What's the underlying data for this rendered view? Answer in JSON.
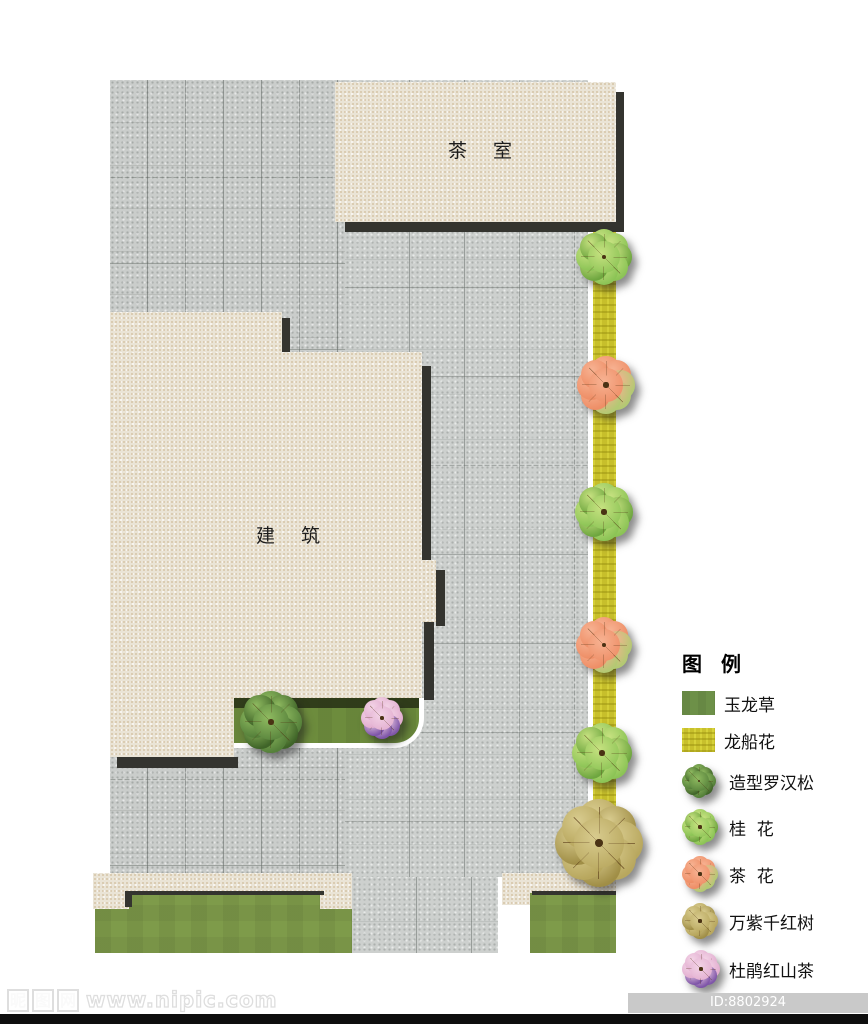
{
  "plan": {
    "labels": {
      "tea_room": "茶   室",
      "building": "建   筑"
    },
    "legend": {
      "title": "图 例",
      "items": [
        {
          "label": "玉龙草",
          "swatch": "grass-green"
        },
        {
          "label": "龙船花",
          "swatch": "hedge-yellow"
        },
        {
          "label": "造型罗汉松",
          "swatch": "tree",
          "tree_type": "luohansong"
        },
        {
          "label": "桂  花",
          "swatch": "tree",
          "tree_type": "guihua"
        },
        {
          "label": "茶  花",
          "swatch": "tree",
          "tree_type": "chahua"
        },
        {
          "label": "万紫千红树",
          "swatch": "tree",
          "tree_type": "wanzi"
        },
        {
          "label": "杜鹃红山茶",
          "swatch": "tree",
          "tree_type": "dujuan"
        }
      ]
    },
    "trees": [
      {
        "type": "guihua",
        "x": 604,
        "y": 257,
        "size": 54
      },
      {
        "type": "chahua",
        "x": 606,
        "y": 385,
        "size": 56
      },
      {
        "type": "guihua",
        "x": 604,
        "y": 512,
        "size": 56
      },
      {
        "type": "chahua",
        "x": 604,
        "y": 645,
        "size": 54
      },
      {
        "type": "guihua",
        "x": 602,
        "y": 753,
        "size": 58
      },
      {
        "type": "wanzi",
        "x": 599,
        "y": 843,
        "size": 84
      },
      {
        "type": "luohansong",
        "x": 271,
        "y": 722,
        "size": 60
      },
      {
        "type": "dujuan",
        "x": 382,
        "y": 718,
        "size": 40
      }
    ],
    "tree_palettes": {
      "luohansong": {
        "base": "#55803a",
        "accent": "#3f6428",
        "hl": "#8fba60",
        "accent_petals": [
          1,
          3,
          5,
          7
        ]
      },
      "guihua": {
        "base": "#8cc456",
        "accent": "#6ea63f",
        "hl": "#c6e180",
        "accent_petals": [
          2,
          5,
          7
        ]
      },
      "chahua": {
        "base": "#ee8e66",
        "accent": "#b3c973",
        "hl": "#f7b292",
        "accent_petals": [
          2,
          3,
          4
        ]
      },
      "wanzi": {
        "base": "#b8a75e",
        "accent": "#a08e46",
        "hl": "#d8cb8e",
        "accent_petals": [
          1,
          4,
          6
        ]
      },
      "dujuan": {
        "base": "#e2aed0",
        "accent": "#7e55a8",
        "hl": "#f3d3e6",
        "accent_petals": [
          3,
          4,
          5
        ]
      }
    },
    "colors": {
      "pavement_gray": "#caccca",
      "slab_beige": "#eae4d6",
      "shadow_dark": "#34342f",
      "hedge_yellow": "#c7bf2b",
      "lawn_green": "#7e9b4a",
      "strip_lawn_green": "#6d8c3d"
    }
  },
  "watermark": {
    "logo_chars": [
      "昵",
      "图",
      "网"
    ],
    "url_text": "www.nipic.com",
    "id_badge": "ID:8802924 NO:20200108184940124084"
  }
}
